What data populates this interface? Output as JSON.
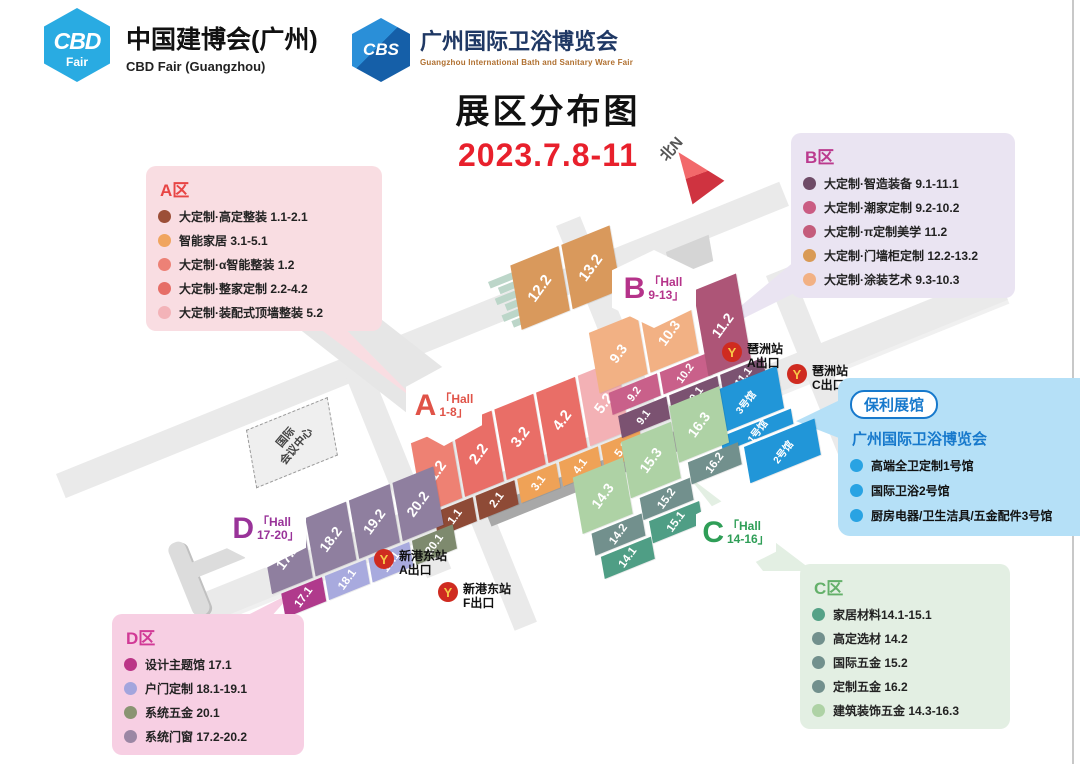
{
  "header": {
    "cbd_badge_line1": "CBD",
    "cbd_badge_line2": "Fair",
    "cbd_title": "中国建博会(广州)",
    "cbd_subtitle": "CBD Fair (Guangzhou)",
    "cbs_badge": "CBS",
    "cbs_title": "广州国际卫浴博览会",
    "cbs_subtitle": "Guangzhou International Bath and Sanitary Ware Fair"
  },
  "title": {
    "main": "展区分布图",
    "date": "2023.7.8-11"
  },
  "north_label": "北N",
  "legend_a": {
    "title": "A区",
    "items": [
      {
        "color": "#9c4f38",
        "label": "大定制·高定整装 1.1-2.1"
      },
      {
        "color": "#f0a55f",
        "label": "智能家居 3.1-5.1"
      },
      {
        "color": "#ed8176",
        "label": "大定制·α智能整装 1.2"
      },
      {
        "color": "#e66e67",
        "label": "大定制·整家定制 2.2-4.2"
      },
      {
        "color": "#f3b3b8",
        "label": "大定制·装配式顶墙整装 5.2"
      }
    ]
  },
  "legend_b": {
    "title": "B区",
    "items": [
      {
        "color": "#6f4b67",
        "label": "大定制·智造装备 9.1-11.1"
      },
      {
        "color": "#ca5c83",
        "label": "大定制·潮家定制 9.2-10.2"
      },
      {
        "color": "#c45c7b",
        "label": "大定制·π定制美学 11.2"
      },
      {
        "color": "#d99a55",
        "label": "大定制·门墙柜定制 12.2-13.2"
      },
      {
        "color": "#f2b184",
        "label": "大定制·涂装艺术 9.3-10.3"
      }
    ]
  },
  "legend_c": {
    "title": "C区",
    "items": [
      {
        "color": "#55a287",
        "label": "家居材料14.1-15.1"
      },
      {
        "color": "#72908d",
        "label": "高定选材 14.2"
      },
      {
        "color": "#72908d",
        "label": "国际五金 15.2"
      },
      {
        "color": "#72908d",
        "label": "定制五金 16.2"
      },
      {
        "color": "#aed2a5",
        "label": "建筑装饰五金 14.3-16.3"
      }
    ]
  },
  "legend_d": {
    "title": "D区",
    "items": [
      {
        "color": "#bb3587",
        "label": "设计主题馆 17.1"
      },
      {
        "color": "#a3a5dd",
        "label": "户门定制 18.1-19.1"
      },
      {
        "color": "#8a9472",
        "label": "系统五金 20.1"
      },
      {
        "color": "#9b87a4",
        "label": "系统门窗 17.2-20.2"
      }
    ]
  },
  "poly_pavilion": {
    "tag": "保利展馆",
    "title": "广州国际卫浴博览会",
    "dot_color": "#29a3e3",
    "items": [
      "高端全卫定制1号馆",
      "国际卫浴2号馆",
      "厨房电器/卫生洁具/五金配件3号馆"
    ]
  },
  "hex_a": {
    "letter": "A",
    "line1": "「Hall",
    "line2": "1-8」"
  },
  "hex_b": {
    "letter": "B",
    "line1": "「Hall",
    "line2": "9-13」"
  },
  "hex_c": {
    "letter": "C",
    "line1": "「Hall",
    "line2": "14-16」"
  },
  "hex_d": {
    "letter": "D",
    "line1": "「Hall",
    "line2": "17-20」"
  },
  "metro": [
    {
      "icon": "metro-y-icon",
      "station": "琶洲站",
      "exit": "A出口"
    },
    {
      "icon": "metro-y-icon",
      "station": "琶洲站",
      "exit": "C出口"
    },
    {
      "icon": "metro-y-icon",
      "station": "新港东站",
      "exit": "A出口"
    },
    {
      "icon": "metro-y-icon",
      "station": "新港东站",
      "exit": "F出口"
    },
    {
      "icon_glyph": "Y"
    }
  ],
  "convention_center": {
    "line1": "国际",
    "line2": "会议中心"
  },
  "halls": {
    "a_large": [
      {
        "id": "1.2",
        "color": "#ee8173"
      },
      {
        "id": "2.2",
        "color": "#e96e67"
      },
      {
        "id": "3.2",
        "color": "#e96e67"
      },
      {
        "id": "4.2",
        "color": "#e96e67"
      },
      {
        "id": "5.2",
        "color": "#f3b1b5"
      }
    ],
    "a_small": [
      {
        "id": "1.1",
        "color": "#8e4a36"
      },
      {
        "id": "2.1",
        "color": "#8e4a36"
      },
      {
        "id": "3.1",
        "color": "#efa257"
      },
      {
        "id": "4.1",
        "color": "#efa257"
      },
      {
        "id": "5.1",
        "color": "#efa257"
      }
    ],
    "b_top": [
      {
        "id": "12.2",
        "color": "#d9995c"
      },
      {
        "id": "13.2",
        "color": "#d9995c"
      }
    ],
    "b_col9": [
      {
        "id": "9.3",
        "color": "#f2b184"
      },
      {
        "id": "9.2",
        "color": "#c9608a"
      },
      {
        "id": "9.1",
        "color": "#7b5271"
      }
    ],
    "b_col10": [
      {
        "id": "10.3",
        "color": "#f2b184"
      },
      {
        "id": "10.2",
        "color": "#c9608a"
      },
      {
        "id": "10.1",
        "color": "#7b5271"
      }
    ],
    "b_col11": [
      {
        "id": "11.2",
        "color": "#ad5577"
      },
      {
        "id": "11.1",
        "color": "#7b5271"
      }
    ],
    "c_col14": [
      {
        "id": "14.3",
        "color": "#aed2a5"
      },
      {
        "id": "14.2",
        "color": "#72908d"
      },
      {
        "id": "14.1",
        "color": "#4f9e85"
      }
    ],
    "c_col15": [
      {
        "id": "15.3",
        "color": "#aed2a5"
      },
      {
        "id": "15.2",
        "color": "#72908d"
      },
      {
        "id": "15.1",
        "color": "#4f9e85"
      }
    ],
    "c_col16": [
      {
        "id": "16.3",
        "color": "#aed2a5"
      },
      {
        "id": "16.2",
        "color": "#72908d"
      }
    ],
    "d_large": [
      {
        "id": "17.2",
        "color": "#8f7f9f"
      },
      {
        "id": "18.2",
        "color": "#8f7f9f"
      },
      {
        "id": "19.2",
        "color": "#8f7f9f"
      },
      {
        "id": "20.2",
        "color": "#8f7f9f"
      }
    ],
    "d_small": [
      {
        "id": "17.1",
        "color": "#b03a8c"
      },
      {
        "id": "18.1",
        "color": "#a8aade"
      },
      {
        "id": "19.1",
        "color": "#a8aade"
      },
      {
        "id": "20.1",
        "color": "#7e8a6e"
      }
    ],
    "poly": [
      {
        "id": "3号馆",
        "color": "#2196d8"
      },
      {
        "id": "1号馆",
        "color": "#2196d8"
      },
      {
        "id": "2号馆",
        "color": "#2196d8"
      }
    ]
  }
}
